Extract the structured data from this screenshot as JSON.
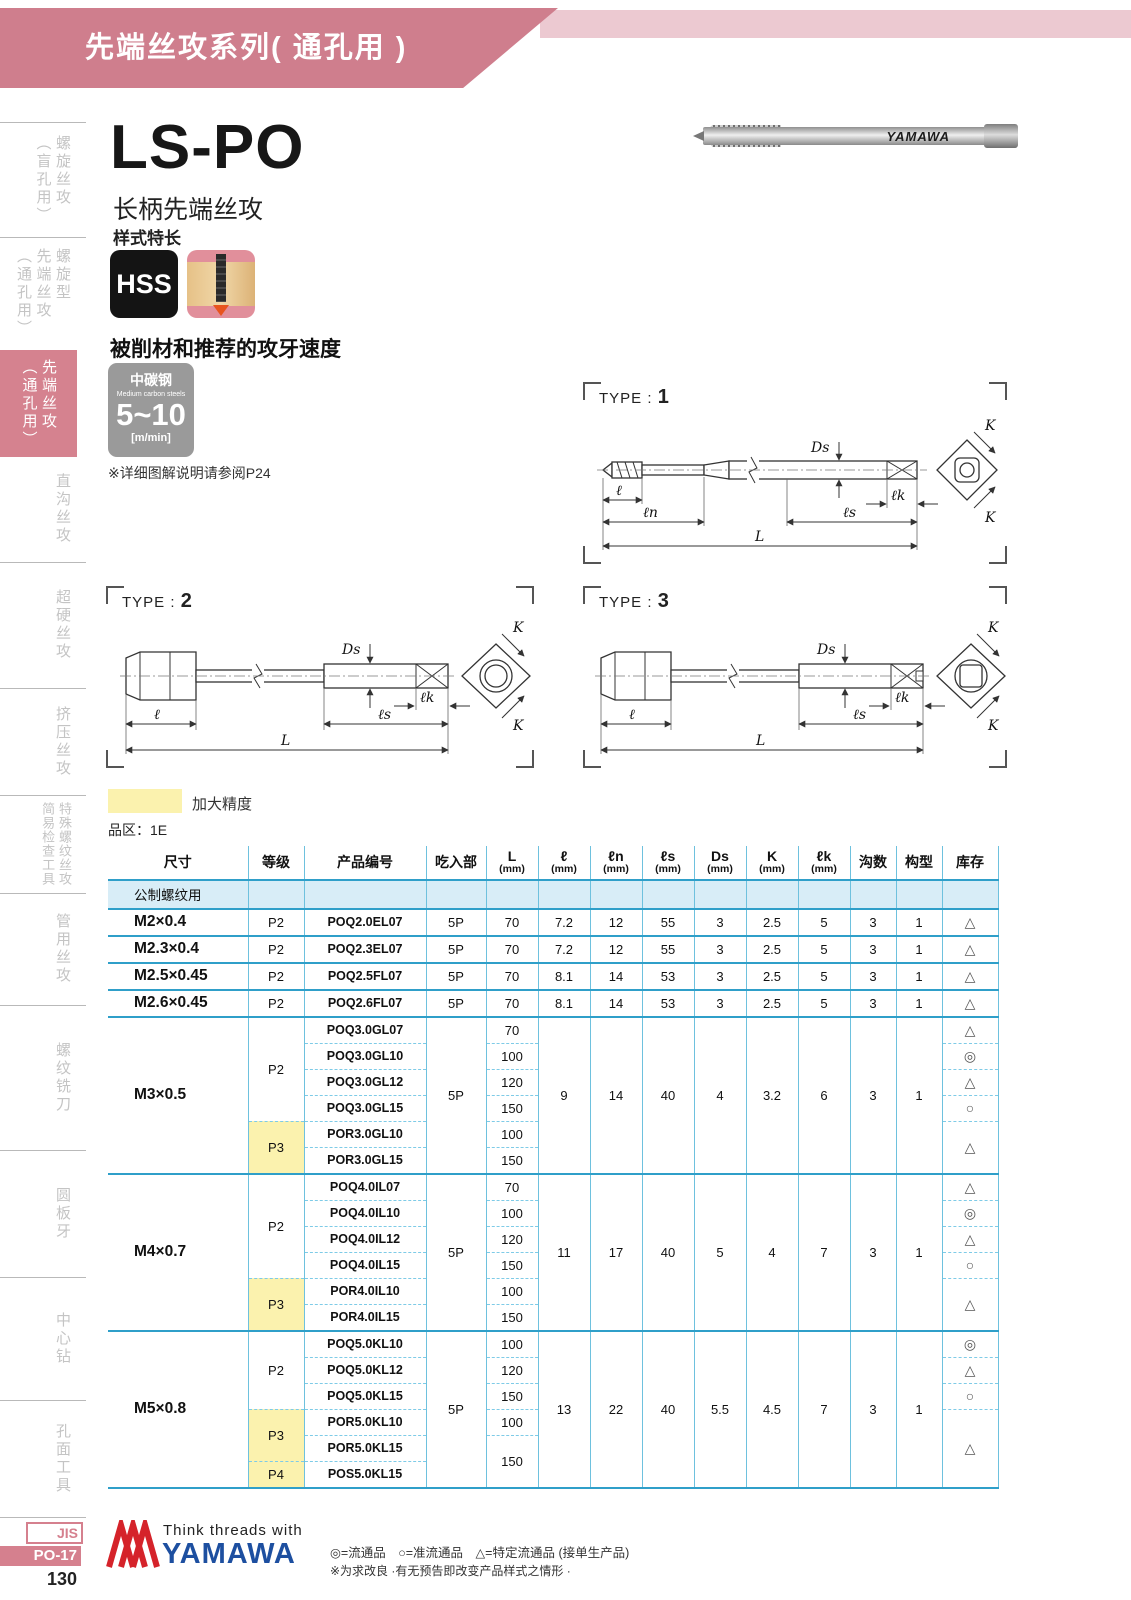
{
  "header": {
    "title": "先端丝攻系列( 通孔用 )"
  },
  "sidebar": {
    "items": [
      {
        "label": "螺旋丝攻\n（盲孔用）"
      },
      {
        "label": "螺旋型\n先端丝攻\n（通孔用）"
      },
      {
        "label": "先端丝攻\n（通孔用）"
      },
      {
        "label": "直沟丝攻"
      },
      {
        "label": "超硬丝攻"
      },
      {
        "label": "挤压丝攻"
      },
      {
        "label": "特殊螺纹丝攻\n简易检查工具"
      },
      {
        "label": "管用丝攻"
      },
      {
        "label": "螺纹铣刀"
      },
      {
        "label": "圆板牙"
      },
      {
        "label": "中心钻"
      },
      {
        "label": "孔面工具"
      }
    ],
    "jis": "JIS",
    "code": "PO-17",
    "page": "130"
  },
  "product": {
    "model": "LS-PO",
    "name": "长柄先端丝攻",
    "style": "样式特长",
    "hss": "HSS",
    "speed_title": "被削材和推荐的攻牙速度",
    "speed": {
      "material_cn": "中碳钢",
      "material_en": "Medium carbon steels",
      "range": "5~10",
      "unit": "[m/min]"
    },
    "note": "※详细图解说明请参阅P24",
    "photo_brand": "YAMAWA"
  },
  "legend": {
    "swatch_label": "加大精度",
    "series": "品区：1E"
  },
  "diagrams": {
    "t1": {
      "label": "TYPE :",
      "num": "1"
    },
    "t2": {
      "label": "TYPE :",
      "num": "2"
    },
    "t3": {
      "label": "TYPE :",
      "num": "3"
    },
    "dims": {
      "L": "L",
      "l": "ℓ",
      "ln": "ℓn",
      "ls": "ℓs",
      "lk": "ℓk",
      "ds": "Ds",
      "k": "K"
    }
  },
  "table": {
    "h": {
      "size": "尺寸",
      "grade": "等级",
      "code": "产品编号",
      "chamfer": "吃入部",
      "L": "L",
      "l": "ℓ",
      "ln": "ℓn",
      "ls": "ℓs",
      "ds": "Ds",
      "k": "K",
      "lk": "ℓk",
      "flutes": "沟数",
      "form": "构型",
      "stock": "库存"
    },
    "mm": "(mm)",
    "section": "公制螺纹用",
    "g0": {
      "size": "M2×0.4",
      "grade": "P2",
      "code": "POQ2.0EL07",
      "chamfer": "5P",
      "L": "70",
      "l": "7.2",
      "ln": "12",
      "ls": "55",
      "ds": "3",
      "k": "2.5",
      "lk": "5",
      "flutes": "3",
      "form": "1",
      "stock": "△"
    },
    "g1": {
      "size": "M2.3×0.4",
      "grade": "P2",
      "code": "POQ2.3EL07",
      "chamfer": "5P",
      "L": "70",
      "l": "7.2",
      "ln": "12",
      "ls": "55",
      "ds": "3",
      "k": "2.5",
      "lk": "5",
      "flutes": "3",
      "form": "1",
      "stock": "△"
    },
    "g2": {
      "size": "M2.5×0.45",
      "grade": "P2",
      "code": "POQ2.5FL07",
      "chamfer": "5P",
      "L": "70",
      "l": "8.1",
      "ln": "14",
      "ls": "53",
      "ds": "3",
      "k": "2.5",
      "lk": "5",
      "flutes": "3",
      "form": "1",
      "stock": "△"
    },
    "g3": {
      "size": "M2.6×0.45",
      "grade": "P2",
      "code": "POQ2.6FL07",
      "chamfer": "5P",
      "L": "70",
      "l": "8.1",
      "ln": "14",
      "ls": "53",
      "ds": "3",
      "k": "2.5",
      "lk": "5",
      "flutes": "3",
      "form": "1",
      "stock": "△"
    },
    "g4": {
      "size": "M3×0.5",
      "p2": "P2",
      "p3": "P3",
      "chamfer": "5P",
      "l": "9",
      "ln": "14",
      "ls": "40",
      "ds": "4",
      "k": "3.2",
      "lk": "6",
      "flutes": "3",
      "form": "1",
      "p3_stock": "△",
      "r0": {
        "code": "POQ3.0GL07",
        "L": "70",
        "stock": "△"
      },
      "r1": {
        "code": "POQ3.0GL10",
        "L": "100",
        "stock": "◎"
      },
      "r2": {
        "code": "POQ3.0GL12",
        "L": "120",
        "stock": "△"
      },
      "r3": {
        "code": "POQ3.0GL15",
        "L": "150",
        "stock": "○"
      },
      "r4": {
        "code": "POR3.0GL10",
        "L": "100"
      },
      "r5": {
        "code": "POR3.0GL15",
        "L": "150"
      }
    },
    "g5": {
      "size": "M4×0.7",
      "p2": "P2",
      "p3": "P3",
      "chamfer": "5P",
      "l": "11",
      "ln": "17",
      "ls": "40",
      "ds": "5",
      "k": "4",
      "lk": "7",
      "flutes": "3",
      "form": "1",
      "p3_stock": "△",
      "r0": {
        "code": "POQ4.0IL07",
        "L": "70",
        "stock": "△"
      },
      "r1": {
        "code": "POQ4.0IL10",
        "L": "100",
        "stock": "◎"
      },
      "r2": {
        "code": "POQ4.0IL12",
        "L": "120",
        "stock": "△"
      },
      "r3": {
        "code": "POQ4.0IL15",
        "L": "150",
        "stock": "○"
      },
      "r4": {
        "code": "POR4.0IL10",
        "L": "100"
      },
      "r5": {
        "code": "POR4.0IL15",
        "L": "150"
      }
    },
    "g6": {
      "size": "M5×0.8",
      "p2": "P2",
      "p3": "P3",
      "p4": "P4",
      "chamfer": "5P",
      "l": "13",
      "ln": "22",
      "ls": "40",
      "ds": "5.5",
      "k": "4.5",
      "lk": "7",
      "flutes": "3",
      "form": "1",
      "p3_stock": "△",
      "L45": "150",
      "r0": {
        "code": "POQ5.0KL10",
        "L": "100",
        "stock": "◎"
      },
      "r1": {
        "code": "POQ5.0KL12",
        "L": "120",
        "stock": "△"
      },
      "r2": {
        "code": "POQ5.0KL15",
        "L": "150",
        "stock": "○"
      },
      "r3": {
        "code": "POR5.0KL10",
        "L": "100"
      },
      "r4": {
        "code": "POR5.0KL15"
      },
      "r5": {
        "code": "POS5.0KL15"
      }
    }
  },
  "footer": {
    "brand_top": "Think threads with",
    "brand": "YAMAWA",
    "stock_legend": "◎=流通品　○=准流通品　△=特定流通品 (接单生产品)",
    "note": "※为求改良 ·有无预告即改变产品样式之情形 ·"
  }
}
